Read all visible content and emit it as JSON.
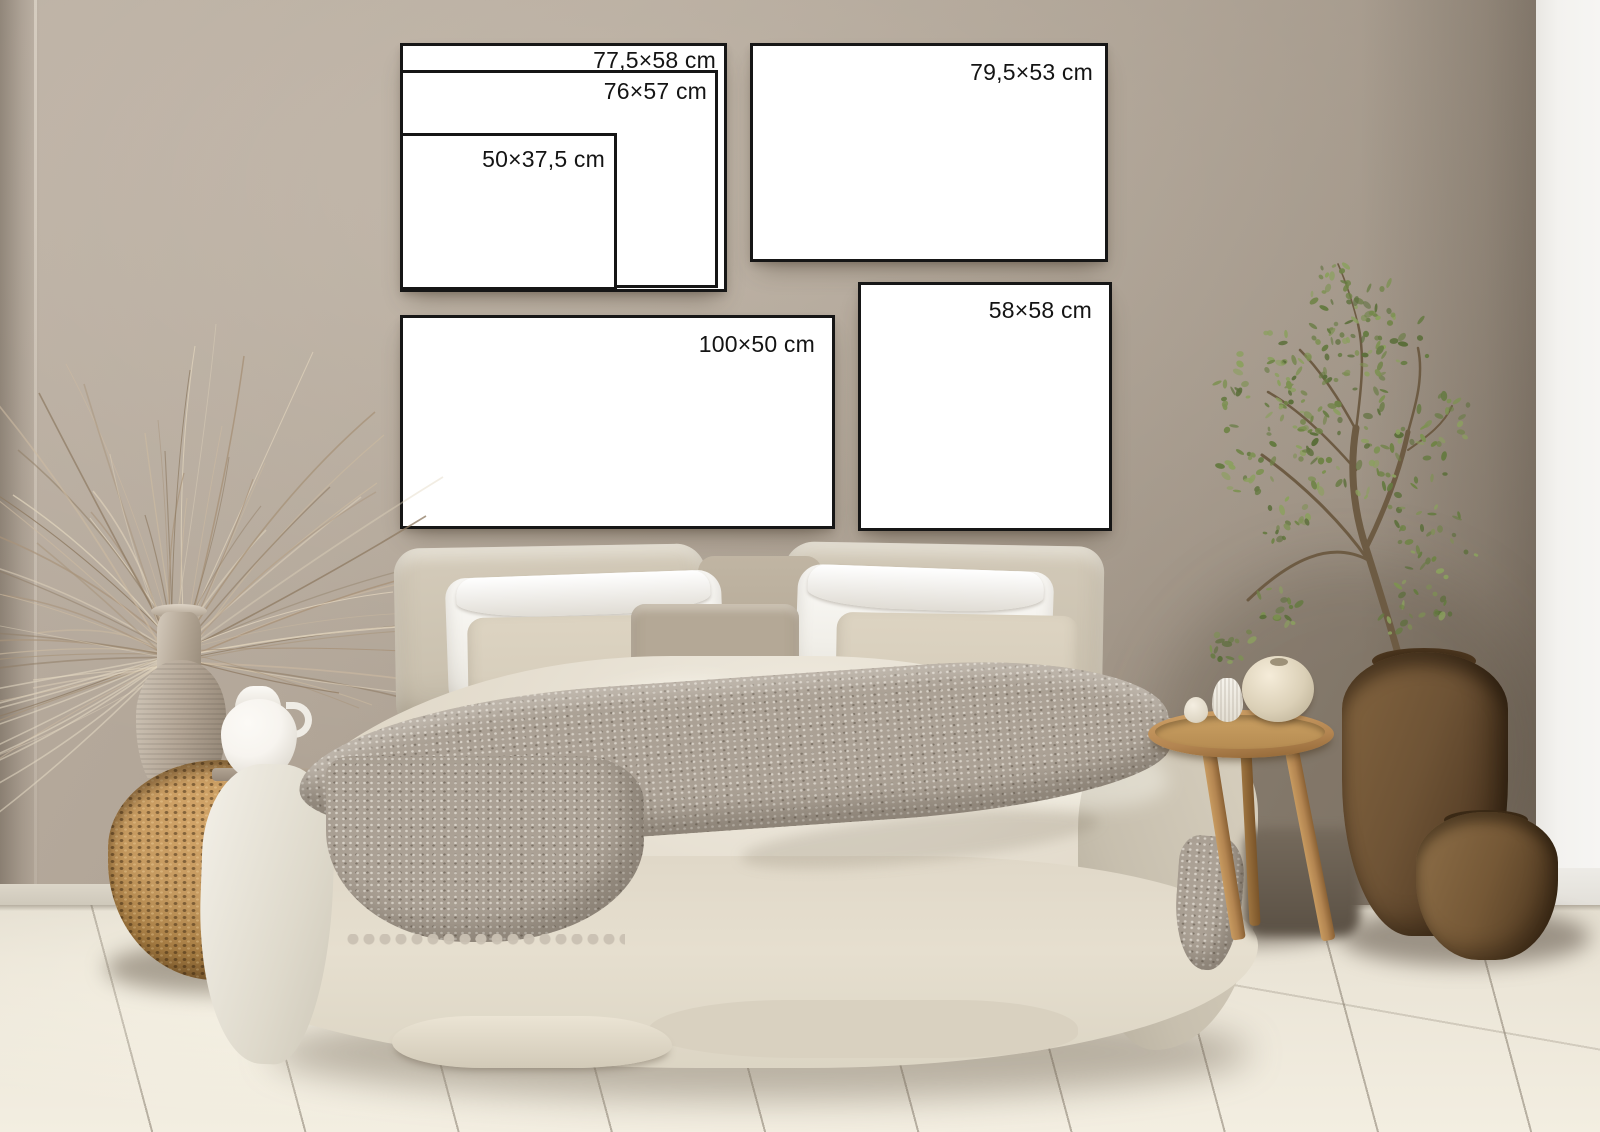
{
  "frames": {
    "nested_outer": {
      "label": "77,5×58 cm"
    },
    "nested_mid": {
      "label": "76×57 cm"
    },
    "nested_small": {
      "label": "50×37,5 cm"
    },
    "landscape_top_right": {
      "label": "79,5×53 cm"
    },
    "square_right": {
      "label": "58×58 cm"
    },
    "panorama_bottom_left": {
      "label": "100×50 cm"
    }
  },
  "palette": {
    "wall-light": "#b9ada0",
    "wall-mid": "#a89c8e",
    "wall-dark": "#8a7e70",
    "white-wall": "#f3f2ef",
    "floor-base": "#eae4d6",
    "floor-light": "#f3eee1",
    "frame-border": "#161616",
    "frame-face": "#ffffff",
    "label-text": "#141414",
    "duvet": "#e0d8c8",
    "duvet-bright": "#f0ebe0",
    "duvet-shade": "#cdc5b4",
    "pillow-euro": "#cbc2b0",
    "pillow-white": "#fbfaf7",
    "pillow-beige": "#d8cfbd",
    "pillow-velvet": "#b4a896",
    "throw": "#aba195",
    "throw-light": "#cac1b3",
    "wicker-light": "#c59a60",
    "wicker-dark": "#7c5a30",
    "basket-brown": "#6e5335",
    "basket-deep": "#49331e",
    "wood": "#b38551",
    "ceramic-vase": "#b2a494",
    "jug-white": "#f7f4ef",
    "leaf-green": "#6f8346",
    "dried-tan": "#cdbba1"
  }
}
